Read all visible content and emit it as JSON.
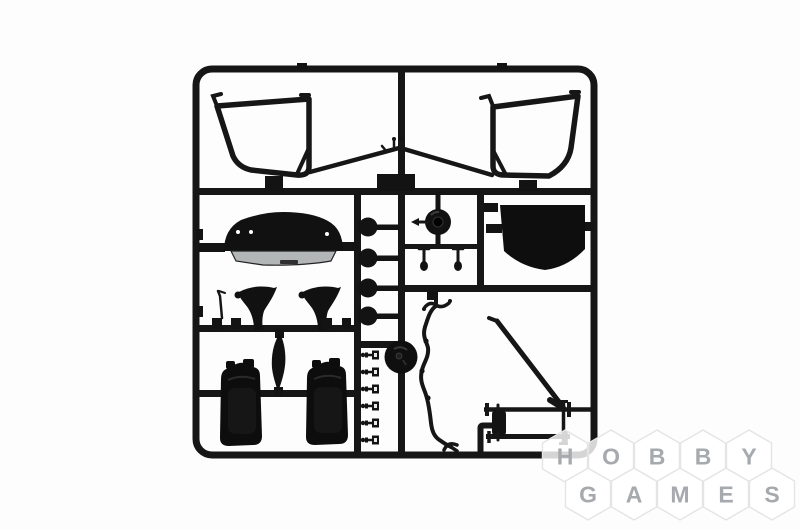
{
  "watermark": {
    "line1": [
      "H",
      "O",
      "B",
      "B",
      "Y"
    ],
    "line2": [
      "G",
      "A",
      "M",
      "E",
      "S"
    ],
    "letter_color": "#a6a9ad",
    "hex_fill": "#ffffff",
    "hex_border": "#e2e4e6"
  },
  "photo": {
    "background_color": "#fdfdfd",
    "plastic_color": "#141414",
    "dashboard_base_color": "#b3b6b6"
  }
}
